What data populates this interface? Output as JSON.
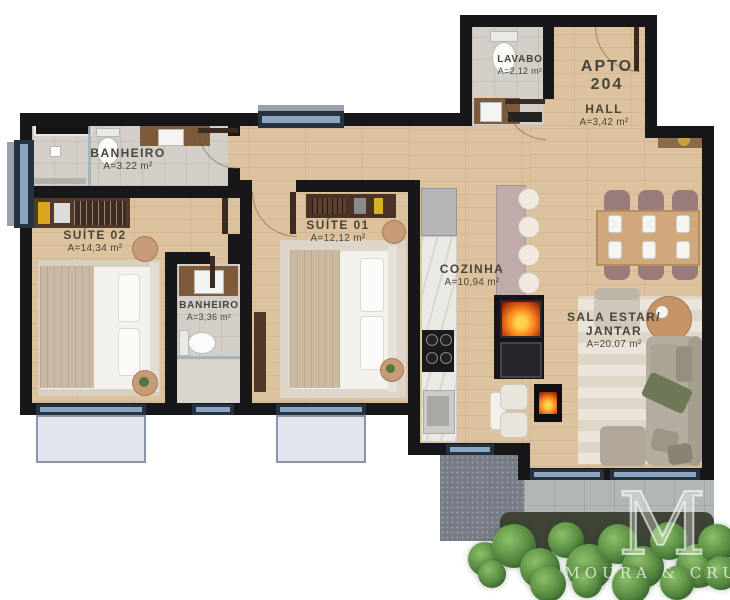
{
  "floorplan": {
    "unit": {
      "label": "APTO",
      "number": "204"
    },
    "rooms": [
      {
        "name": "LAVABO",
        "area": "A=2,12 m²"
      },
      {
        "name": "HALL",
        "area": "A=3,42 m²"
      },
      {
        "name": "BANHEIRO",
        "area": "A=3.22 m²"
      },
      {
        "name": "SUÍTE 02",
        "area": "A=14,34 m²"
      },
      {
        "name": "SUÍTE 01",
        "area": "A=12,12 m²"
      },
      {
        "name": "BANHEIRO",
        "area": "A=3,36 m²"
      },
      {
        "name": "COZINHA",
        "area": "A=10,94 m²"
      },
      {
        "name": "SALA ESTAR/",
        "name_line2": "JANTAR",
        "area": "A=20.07 m²"
      }
    ],
    "watermark": {
      "monogram": "M",
      "studio": "MOURA & CRUZ"
    },
    "colors": {
      "wall": "#17171a",
      "wood": "#dcc39d",
      "tile": "#d3cfc8",
      "glass": "#8ba6c0",
      "fire": "#ff8c1f"
    }
  }
}
